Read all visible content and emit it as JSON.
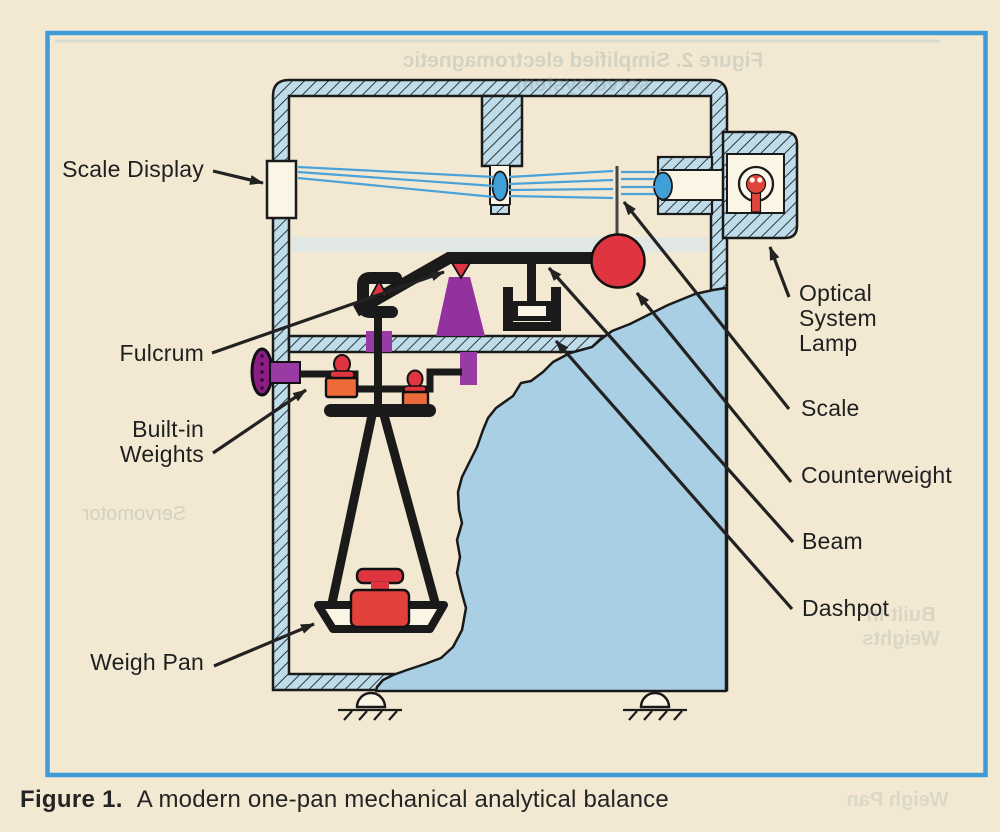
{
  "figure": {
    "caption_number": "Figure 1.",
    "caption_text": "A modern one-pan mechanical analytical balance"
  },
  "labels": {
    "scale_display": "Scale Display",
    "fulcrum": "Fulcrum",
    "built_in_weights": "Built-in\nWeights",
    "weigh_pan": "Weigh Pan",
    "optical_system_lamp": "Optical\nSystem\nLamp",
    "scale": "Scale",
    "counterweight": "Counterweight",
    "beam": "Beam",
    "dashpot": "Dashpot"
  },
  "ghost_text": {
    "top_line": "Figure 2. Simplified electromagnetic servo system",
    "servomotor": "Servomotor",
    "built_in_weights": "Built-in\nWeights",
    "weigh_pan": "Weigh Pan"
  },
  "palette": {
    "page_background": "#f3e9d3",
    "figure_border_blue": "#3f9bd7",
    "ink_black": "#1f1f1f",
    "case_wall_blue": "#bedcea",
    "interior_backdrop_blue": "#a8cfe3",
    "light_ray_blue": "#4aa2d8",
    "lens_blue": "#3f9fd6",
    "red_parts": "#df3540",
    "orange_weights": "#ee6a38",
    "purple_parts": "#93319f",
    "knob_magenta": "#8c1d86",
    "paper_white": "#fbf5e6",
    "ghost_bleedthrough": "#8fa09e"
  }
}
